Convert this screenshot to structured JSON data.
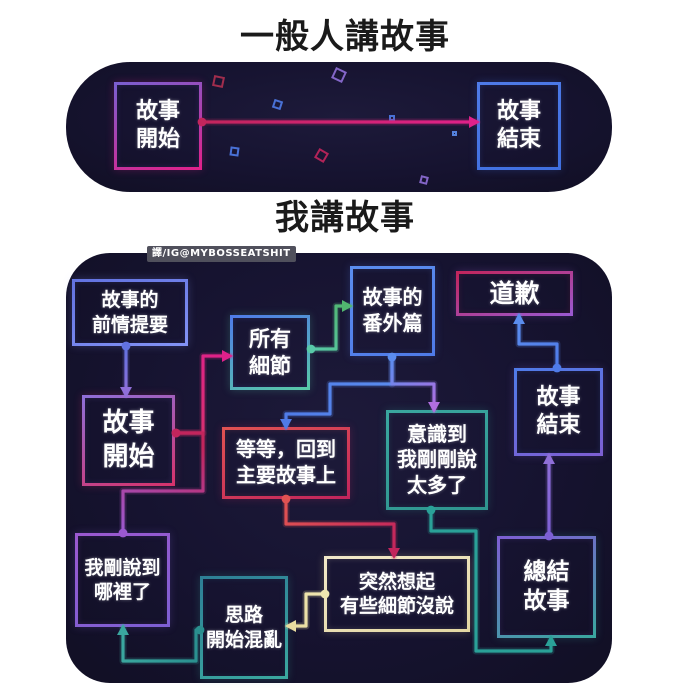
{
  "titles": {
    "normal": "一般人講故事",
    "me": "我講故事"
  },
  "watermark": "譯/IG@MYBOSSEATSHIT",
  "colors": {
    "page_bg": "#ffffff",
    "panel_bg": "#161330",
    "title_text": "#1a1a1a",
    "node_text": "#ffffff"
  },
  "top_diagram": {
    "nodes": [
      {
        "id": "story-start-simple",
        "label": [
          "故事",
          "開始"
        ],
        "x": 114,
        "y": 82,
        "w": 88,
        "h": 88,
        "fs": 22,
        "border": [
          "#7a5fd0",
          "#e0218a"
        ]
      },
      {
        "id": "story-end-simple",
        "label": [
          "故事",
          "結束"
        ],
        "x": 477,
        "y": 82,
        "w": 84,
        "h": 88,
        "fs": 22,
        "border": [
          "#4f7be8",
          "#3f6fe0"
        ]
      }
    ],
    "edges": [
      {
        "from": "story-start-simple",
        "to": "story-end-simple",
        "points": [
          [
            202,
            122
          ],
          [
            477,
            122
          ]
        ],
        "color": [
          "#c2255c",
          "#e0218a"
        ],
        "dot": "start",
        "arrow": "end"
      }
    ],
    "decor": [
      {
        "x": 213,
        "y": 76,
        "s": 11,
        "c": "#b03050",
        "r": 12
      },
      {
        "x": 273,
        "y": 100,
        "s": 9,
        "c": "#4f7be8",
        "r": 18
      },
      {
        "x": 333,
        "y": 69,
        "s": 12,
        "c": "#8f6fd8",
        "r": 25
      },
      {
        "x": 389,
        "y": 115,
        "s": 6,
        "c": "#4f7be8",
        "r": 0
      },
      {
        "x": 230,
        "y": 147,
        "s": 9,
        "c": "#4f7be8",
        "r": 8
      },
      {
        "x": 316,
        "y": 150,
        "s": 11,
        "c": "#c2255c",
        "r": 30
      },
      {
        "x": 420,
        "y": 176,
        "s": 8,
        "c": "#8f6fd8",
        "r": 15
      },
      {
        "x": 452,
        "y": 131,
        "s": 5,
        "c": "#5b8dee",
        "r": 0
      }
    ]
  },
  "bottom_diagram": {
    "nodes": [
      {
        "id": "story-recap",
        "label": [
          "故事的",
          "前情提要"
        ],
        "x": 72,
        "y": 279,
        "w": 116,
        "h": 67,
        "fs": 19,
        "border": [
          "#6272e0",
          "#8393f5"
        ]
      },
      {
        "id": "all-details",
        "label": [
          "所有",
          "細節"
        ],
        "x": 230,
        "y": 315,
        "w": 80,
        "h": 75,
        "fs": 21,
        "border": [
          "#4f7be8",
          "#58c9a8"
        ]
      },
      {
        "id": "side-story",
        "label": [
          "故事的",
          "番外篇"
        ],
        "x": 350,
        "y": 266,
        "w": 85,
        "h": 90,
        "fs": 20,
        "border": [
          "#5b8dee",
          "#4f7be8"
        ]
      },
      {
        "id": "apology",
        "label": [
          "道歉"
        ],
        "x": 456,
        "y": 271,
        "w": 117,
        "h": 45,
        "fs": 25,
        "border": [
          "#c2255c",
          "#9b59d0"
        ]
      },
      {
        "id": "story-end",
        "label": [
          "故事",
          "結束"
        ],
        "x": 514,
        "y": 368,
        "w": 89,
        "h": 88,
        "fs": 22,
        "border": [
          "#4f7be8",
          "#7d5fd3"
        ]
      },
      {
        "id": "story-start",
        "label": [
          "故事",
          "開始"
        ],
        "x": 82,
        "y": 395,
        "w": 93,
        "h": 91,
        "fs": 26,
        "border": [
          "#8f6fd8",
          "#d6336c"
        ]
      },
      {
        "id": "wait-back-to-main",
        "label": [
          "等等，回到",
          "主要故事上"
        ],
        "x": 222,
        "y": 427,
        "w": 128,
        "h": 72,
        "fs": 20,
        "border": [
          "#e05252",
          "#c2255c"
        ]
      },
      {
        "id": "realize-said-too-much",
        "label": [
          "意識到",
          "我剛剛說",
          "太多了"
        ],
        "x": 386,
        "y": 410,
        "w": 102,
        "h": 100,
        "fs": 20,
        "border": [
          "#3aa79f",
          "#2f958f"
        ]
      },
      {
        "id": "where-was-i",
        "label": [
          "我剛說到",
          "哪裡了"
        ],
        "x": 75,
        "y": 533,
        "w": 95,
        "h": 94,
        "fs": 19,
        "border": [
          "#9b59d0",
          "#7d5fd3"
        ]
      },
      {
        "id": "thoughts-confused",
        "label": [
          "思路",
          "開始混亂"
        ],
        "x": 200,
        "y": 576,
        "w": 88,
        "h": 103,
        "fs": 19,
        "border": [
          "#2e7f96",
          "#3aa79f"
        ]
      },
      {
        "id": "suddenly-remember",
        "label": [
          "突然想起",
          "有些細節沒說"
        ],
        "x": 324,
        "y": 556,
        "w": 146,
        "h": 76,
        "fs": 19,
        "border": [
          "#f2e9c9",
          "#e3d7a3"
        ]
      },
      {
        "id": "summarize-story",
        "label": [
          "總結",
          "故事"
        ],
        "x": 497,
        "y": 536,
        "w": 99,
        "h": 102,
        "fs": 23,
        "border": [
          "#7d5fd3",
          "#3aa79f"
        ]
      }
    ],
    "edges": [
      {
        "from": "story-recap",
        "to": "story-start",
        "points": [
          [
            126,
            346
          ],
          [
            126,
            395
          ]
        ],
        "color": [
          "#6272e0",
          "#8f6fd8"
        ],
        "dot": "start",
        "arrow": "end"
      },
      {
        "from": "story-start",
        "to": "all-details",
        "points": [
          [
            176,
            433
          ],
          [
            203,
            433
          ],
          [
            203,
            356
          ],
          [
            230,
            356
          ]
        ],
        "color": [
          "#d6336c",
          "#e0218a"
        ],
        "dot": "start",
        "arrow": "end"
      },
      {
        "from": "all-details",
        "to": "side-story",
        "points": [
          [
            311,
            349
          ],
          [
            336,
            349
          ],
          [
            336,
            306
          ],
          [
            350,
            306
          ]
        ],
        "color": [
          "#58c9a8",
          "#51b56f"
        ],
        "dot": "start",
        "arrow": "end"
      },
      {
        "from": "side-story",
        "to": "wait-back-to-main",
        "points": [
          [
            392,
            357
          ],
          [
            392,
            384
          ],
          [
            330,
            384
          ],
          [
            330,
            414
          ],
          [
            286,
            414
          ],
          [
            286,
            427
          ]
        ],
        "color": [
          "#5b8dee",
          "#4f7be8"
        ],
        "dot": "start",
        "arrow": "end"
      },
      {
        "from": "side-story",
        "to": "realize-said-too-much",
        "points": [
          [
            392,
            357
          ],
          [
            392,
            384
          ],
          [
            434,
            384
          ],
          [
            434,
            410
          ]
        ],
        "color": [
          "#5b8dee",
          "#b06ee0"
        ],
        "dot": "none",
        "arrow": "end"
      },
      {
        "from": "wait-back-to-main",
        "to": "suddenly-remember",
        "points": [
          [
            286,
            499
          ],
          [
            286,
            524
          ],
          [
            394,
            524
          ],
          [
            394,
            556
          ]
        ],
        "color": [
          "#e05252",
          "#c2255c"
        ],
        "dot": "start",
        "arrow": "end"
      },
      {
        "from": "realize-said-too-much",
        "to": "summarize-story",
        "points": [
          [
            431,
            510
          ],
          [
            431,
            531
          ],
          [
            476,
            531
          ],
          [
            476,
            651
          ],
          [
            551,
            651
          ],
          [
            551,
            638
          ]
        ],
        "color": [
          "#2aa198",
          "#2aa198"
        ],
        "dot": "start",
        "arrow": "end"
      },
      {
        "from": "suddenly-remember",
        "to": "thoughts-confused",
        "points": [
          [
            325,
            594
          ],
          [
            306,
            594
          ],
          [
            306,
            626
          ],
          [
            288,
            626
          ]
        ],
        "color": [
          "#efe6b0",
          "#e8dca0"
        ],
        "dot": "start",
        "arrow": "end"
      },
      {
        "from": "thoughts-confused",
        "to": "where-was-i",
        "points": [
          [
            200,
            630
          ],
          [
            196,
            630
          ],
          [
            196,
            661
          ],
          [
            123,
            661
          ],
          [
            123,
            627
          ]
        ],
        "color": [
          "#2a8f8f",
          "#3aa79f"
        ],
        "dot": "start",
        "arrow": "end"
      },
      {
        "from": "where-was-i",
        "to": "story-start",
        "points": [
          [
            123,
            533
          ],
          [
            123,
            491
          ],
          [
            203,
            491
          ],
          [
            203,
            433
          ],
          [
            176,
            433
          ]
        ],
        "color": [
          "#9b59d0",
          "#c2255c"
        ],
        "dot": "both",
        "arrow": "none"
      },
      {
        "from": "summarize-story",
        "to": "story-end",
        "points": [
          [
            549,
            536
          ],
          [
            549,
            456
          ]
        ],
        "color": [
          "#7d5fd3",
          "#8f6fd8"
        ],
        "dot": "start",
        "arrow": "end"
      },
      {
        "from": "story-end",
        "to": "apology",
        "points": [
          [
            557,
            368
          ],
          [
            557,
            344
          ],
          [
            519,
            344
          ],
          [
            519,
            316
          ]
        ],
        "color": [
          "#4f7be8",
          "#5b8dee"
        ],
        "dot": "start",
        "arrow": "end"
      }
    ]
  }
}
